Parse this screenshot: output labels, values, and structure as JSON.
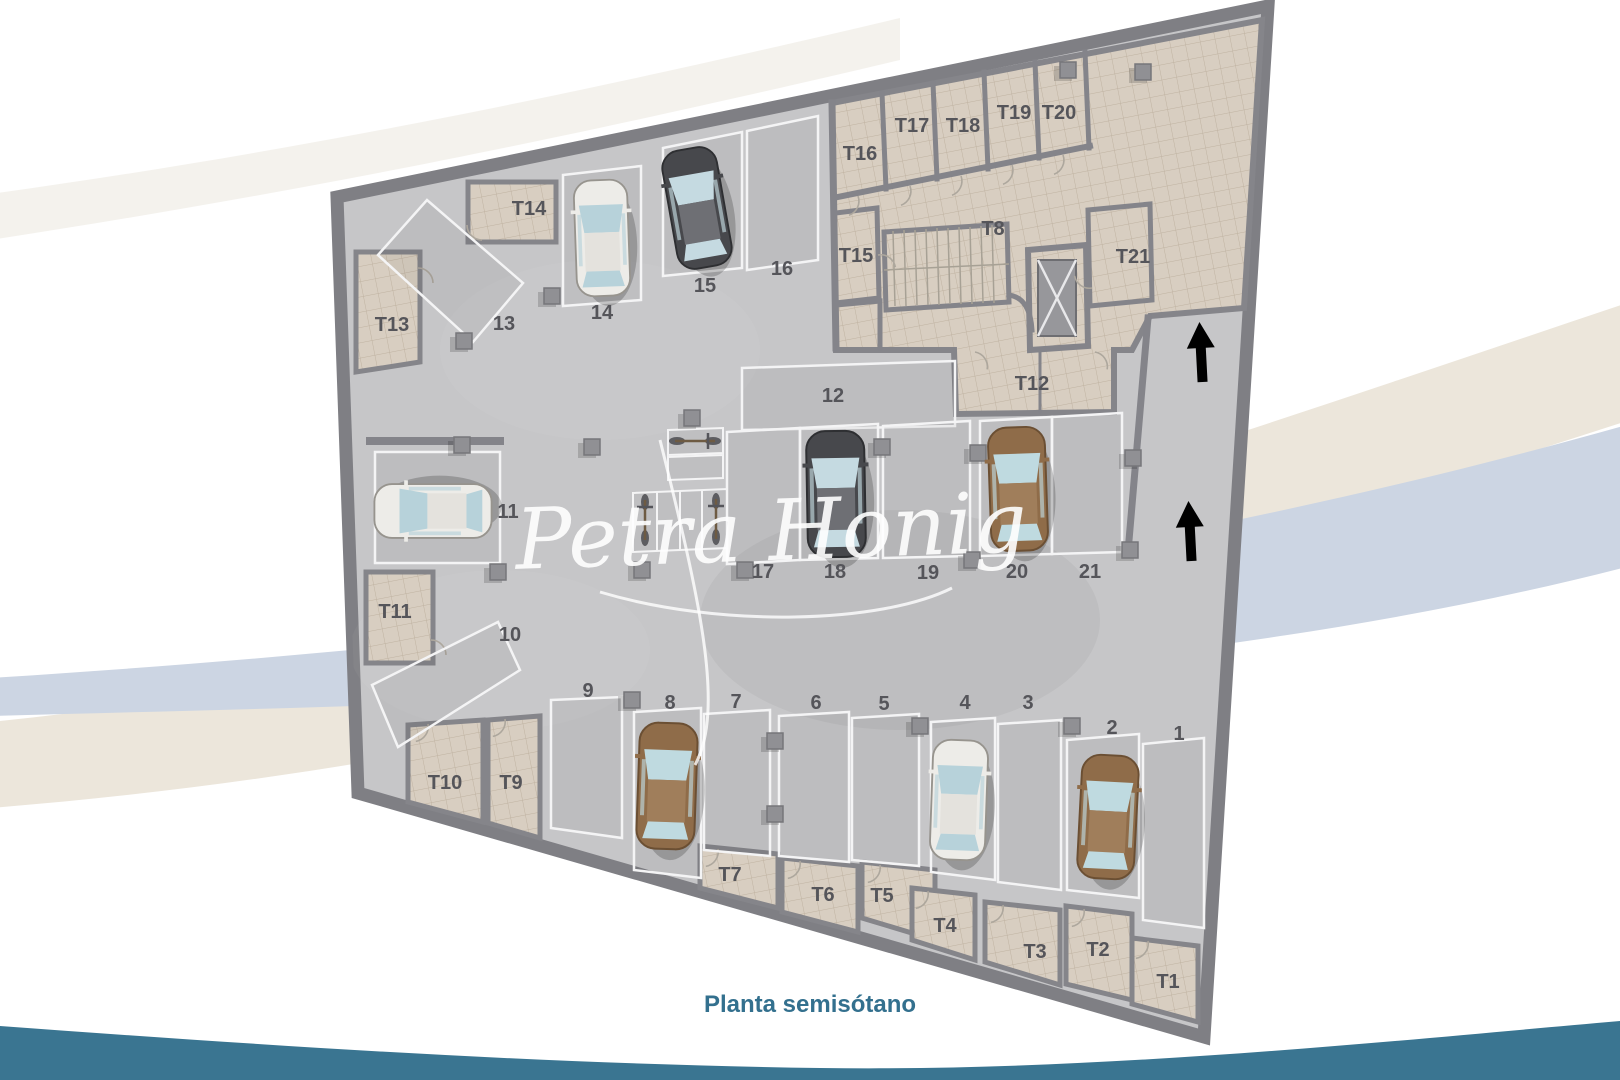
{
  "title": "Planta semisótano",
  "watermark": "Petra Honig",
  "plan": {
    "parking_spaces": [
      {
        "label": "1"
      },
      {
        "label": "2"
      },
      {
        "label": "3"
      },
      {
        "label": "4"
      },
      {
        "label": "5"
      },
      {
        "label": "6"
      },
      {
        "label": "7"
      },
      {
        "label": "8"
      },
      {
        "label": "9"
      },
      {
        "label": "10"
      },
      {
        "label": "11"
      },
      {
        "label": "12"
      },
      {
        "label": "13"
      },
      {
        "label": "14"
      },
      {
        "label": "15"
      },
      {
        "label": "16"
      },
      {
        "label": "17"
      },
      {
        "label": "18"
      },
      {
        "label": "19"
      },
      {
        "label": "20"
      },
      {
        "label": "21"
      }
    ],
    "storage_rooms": [
      {
        "label": "T1"
      },
      {
        "label": "T2"
      },
      {
        "label": "T3"
      },
      {
        "label": "T4"
      },
      {
        "label": "T5"
      },
      {
        "label": "T6"
      },
      {
        "label": "T7"
      },
      {
        "label": "T8"
      },
      {
        "label": "T9"
      },
      {
        "label": "T10"
      },
      {
        "label": "T11"
      },
      {
        "label": "T12"
      },
      {
        "label": "T13"
      },
      {
        "label": "T14"
      },
      {
        "label": "T15"
      },
      {
        "label": "T16"
      },
      {
        "label": "T17"
      },
      {
        "label": "T18"
      },
      {
        "label": "T19"
      },
      {
        "label": "T20"
      },
      {
        "label": "T21"
      }
    ],
    "vehicles": {
      "cars": [
        {
          "space": "2",
          "color": "#8f6c49"
        },
        {
          "space": "4",
          "color": "#edece8"
        },
        {
          "space": "8",
          "color": "#8f6c49"
        },
        {
          "space": "11",
          "color": "#edece8"
        },
        {
          "space": "14",
          "color": "#edece8"
        },
        {
          "space": "15",
          "color": "#47484c"
        },
        {
          "space": "18",
          "color": "#47484c"
        },
        {
          "space": "20",
          "color": "#8f6c49"
        }
      ],
      "motorbikes": 3
    },
    "ramp_arrows": {
      "direction": "up",
      "count": 2
    }
  },
  "colors": {
    "bottom_bar": "#3a7591",
    "caption_text": "#33708e",
    "floor": "#c6c6c8",
    "walls": "#7f7f84",
    "storage_tile": "#d8cec1",
    "swoosh_beige": "#ece6db",
    "swoosh_blue": "#ccd5e3"
  }
}
